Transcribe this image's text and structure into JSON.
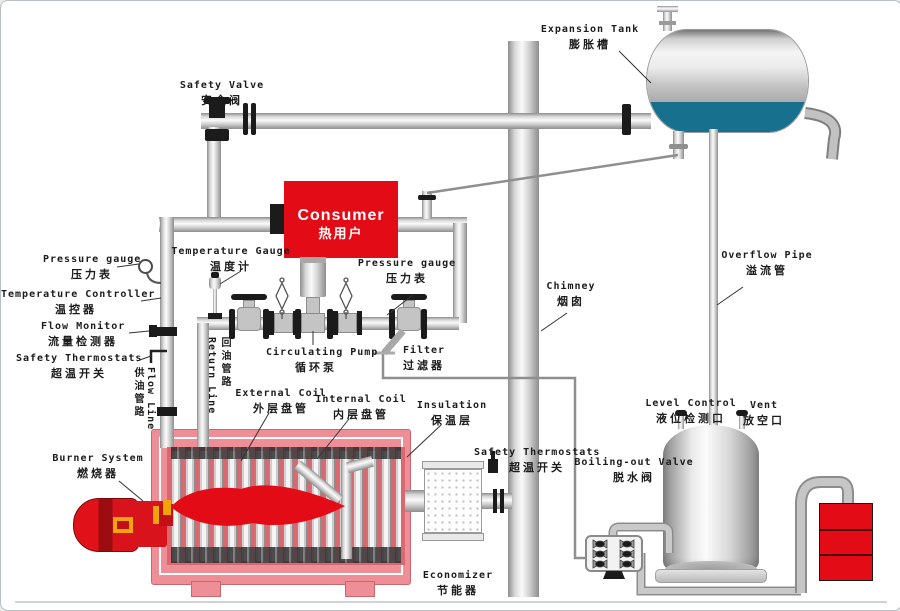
{
  "diagram_type": "thermal-oil-heater-piping-diagram",
  "labels": {
    "safety_valve": {
      "en": "Safety Valve",
      "zh": "安全阀"
    },
    "expansion_tank": {
      "en": "Expansion Tank",
      "zh": "膨胀槽"
    },
    "consumer": {
      "en": "Consumer",
      "zh": "热用户"
    },
    "pressure_gauge_left": {
      "en": "Pressure gauge",
      "zh": "压力表"
    },
    "temperature_controller": {
      "en": "Temperature Controller",
      "zh": "温控器"
    },
    "flow_monitor": {
      "en": "Flow Monitor",
      "zh": "流量检测器"
    },
    "safety_thermostats_left": {
      "en": "Safety Thermostats",
      "zh": "超温开关"
    },
    "temperature_gauge": {
      "en": "Temperature Gauge",
      "zh": "温度计"
    },
    "pressure_gauge_mid": {
      "en": "Pressure gauge",
      "zh": "压力表"
    },
    "circulating_pump": {
      "en": "Circulating Pump",
      "zh": "循环泵"
    },
    "filter": {
      "en": "Filter",
      "zh": "过滤器"
    },
    "return_line": {
      "en": "Return Line",
      "zh": "回油管路"
    },
    "flow_line": {
      "en": "Flow Line",
      "zh": "供油管路"
    },
    "external_coil": {
      "en": "External Coil",
      "zh": "外层盘管"
    },
    "internal_coil": {
      "en": "Internal Coil",
      "zh": "内层盘管"
    },
    "insulation": {
      "en": "Insulation",
      "zh": "保温层"
    },
    "burner_system": {
      "en": "Burner System",
      "zh": "燃烧器"
    },
    "chimney": {
      "en": "Chimney",
      "zh": "烟囱"
    },
    "safety_thermostats_mid": {
      "en": "Safety Thermostats",
      "zh": "超温开关"
    },
    "boiling_out_valve": {
      "en": "Boiling-out Valve",
      "zh": "脱水阀"
    },
    "economizer": {
      "en": "Economizer",
      "zh": "节能器"
    },
    "overflow_pipe": {
      "en": "Overflow Pipe",
      "zh": "溢流管"
    },
    "level_control": {
      "en": "Level Control",
      "zh": "液位检测口"
    },
    "vent": {
      "en": "Vent",
      "zh": "放空口"
    }
  },
  "colors": {
    "red": "#e30b16",
    "heater_shell_pink": "#ee8f98",
    "heater_shell_border": "#c96770",
    "heater_interior": "#db6770",
    "tank_liquid_teal": "#17718e",
    "pipe_gray": "#c9c9c9",
    "label_ink": "#1c1c1c"
  }
}
